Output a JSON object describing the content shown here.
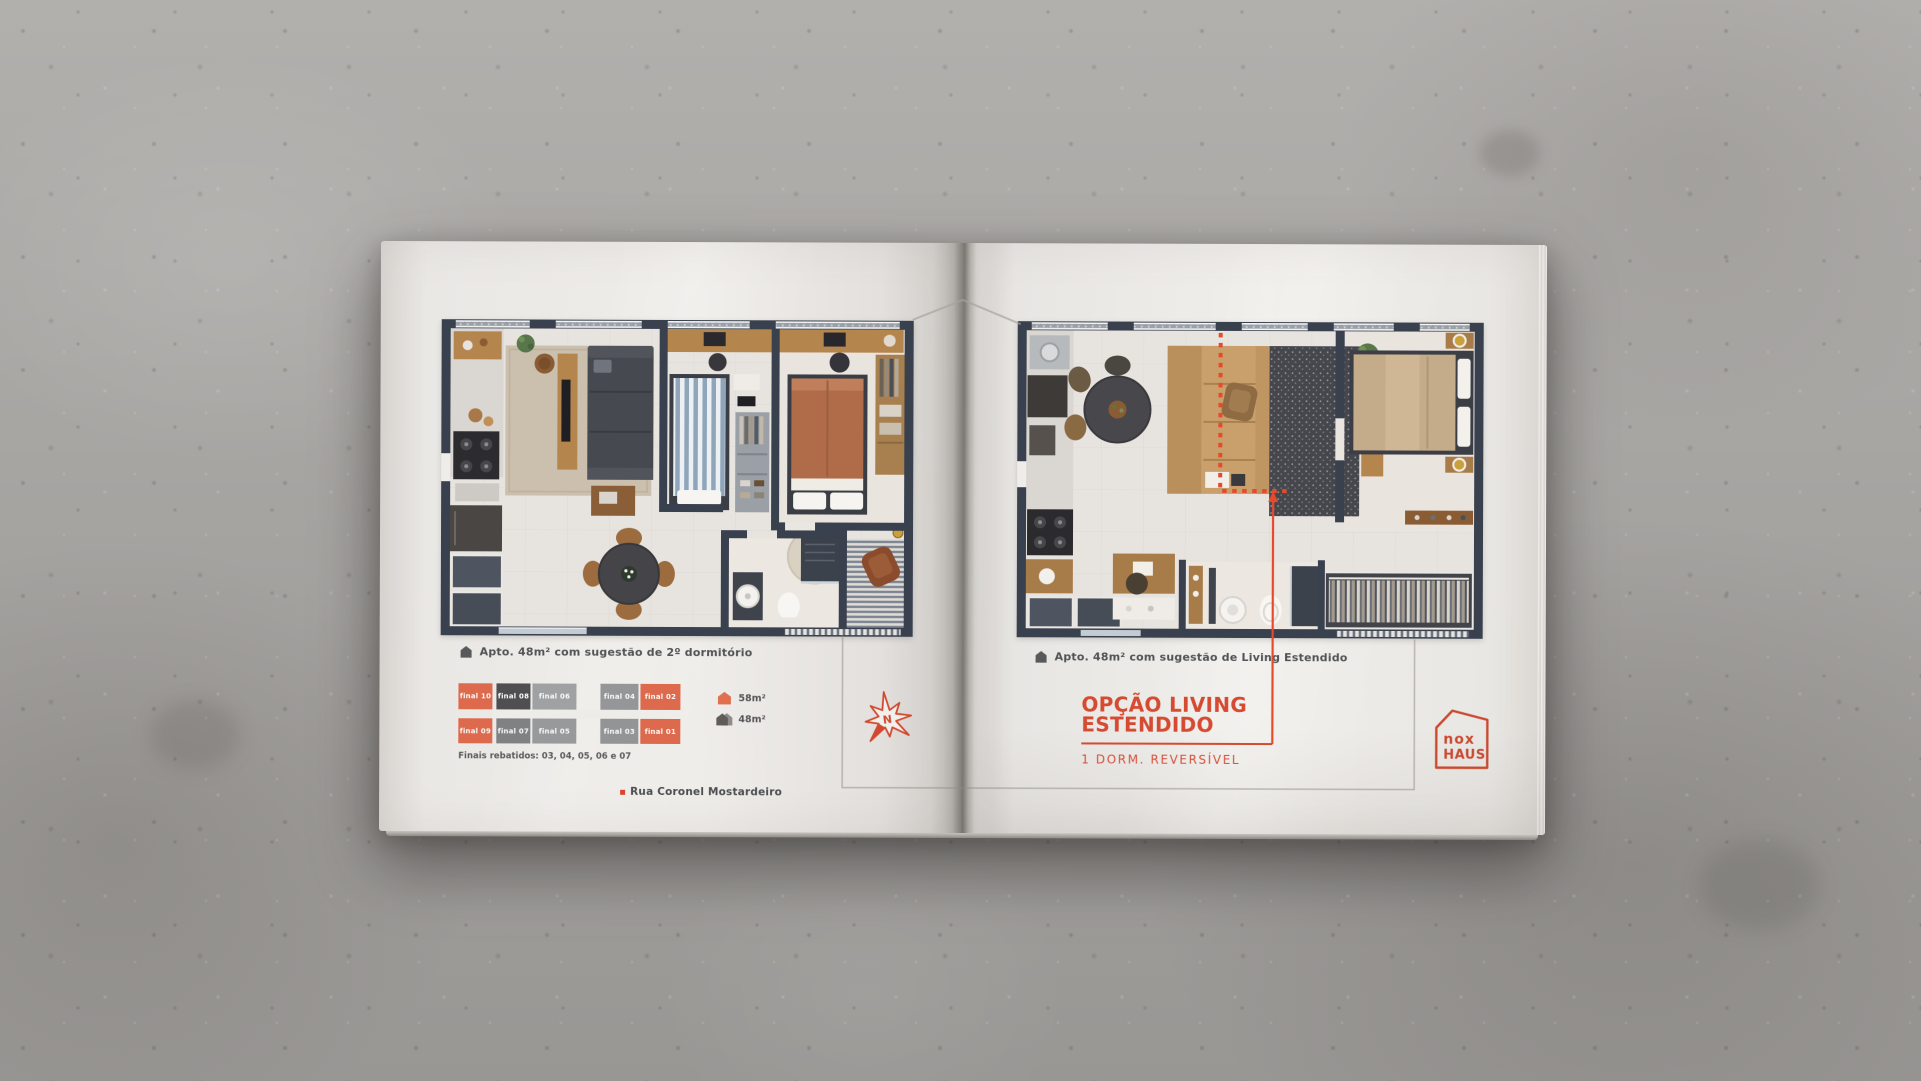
{
  "left_page": {
    "caption": {
      "icon": "house-icon",
      "text": "Apto. 48m² com sugestão de 2º dormitório"
    },
    "keyplan": {
      "units": [
        {
          "label": "final 10",
          "color": "#dd6a4c"
        },
        {
          "label": "final 08",
          "color": "#4f4f51"
        },
        {
          "label": "final 06",
          "color": "#9fa1a2"
        },
        {
          "label": "final 04",
          "color": "#949697"
        },
        {
          "label": "final 02",
          "color": "#dd6a4c"
        },
        {
          "label": "final 09",
          "color": "#dd6a4c"
        },
        {
          "label": "final 07",
          "color": "#808182"
        },
        {
          "label": "final 05",
          "color": "#98999b"
        },
        {
          "label": "final 03",
          "color": "#939495"
        },
        {
          "label": "final 01",
          "color": "#dd6a4c"
        }
      ],
      "note": "Finais rebatidos: 03, 04, 05, 06 e 07"
    },
    "legend": {
      "items": [
        {
          "icon": "house-icon-orange",
          "label": "58m²",
          "color": "#e0704e"
        },
        {
          "icon": "house-icon-gray",
          "label": "48m²",
          "color": "#5f5c59"
        }
      ]
    },
    "compass": {
      "letter": "N",
      "color": "#d14a30"
    },
    "street": {
      "label": "Rua Coronel Mostardeiro",
      "bullet_color": "#d9442f"
    }
  },
  "right_page": {
    "caption": {
      "icon": "house-icon",
      "text": "Apto. 48m² com sugestão de Living Estendido"
    },
    "title": {
      "line1": "OPÇÃO LIVING",
      "line2": "ESTENDIDO",
      "color": "#d54a30"
    },
    "subtitle": "1 DORM. REVERSÍVEL",
    "logo": {
      "line1": "nox",
      "line2": "HAUS",
      "color": "#c94a31"
    }
  }
}
